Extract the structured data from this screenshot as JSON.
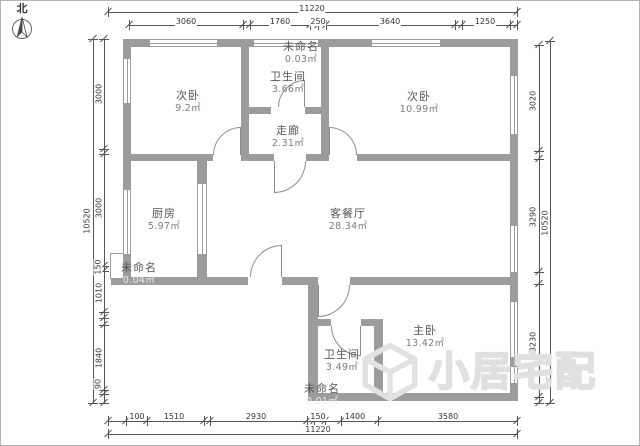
{
  "north": {
    "label": "北"
  },
  "watermark": {
    "brand": "小居宅配"
  },
  "rooms": [
    {
      "id": "bedroom-left",
      "name": "次卧",
      "area": "9.2㎡"
    },
    {
      "id": "bathroom-top",
      "name": "卫生间",
      "area": "3.66㎡"
    },
    {
      "id": "unnamed-top",
      "name": "未命名",
      "area": "0.03㎡"
    },
    {
      "id": "bedroom-right",
      "name": "次卧",
      "area": "10.99㎡"
    },
    {
      "id": "corridor",
      "name": "走廊",
      "area": "2.31㎡"
    },
    {
      "id": "kitchen",
      "name": "厨房",
      "area": "5.97㎡"
    },
    {
      "id": "living-dining",
      "name": "客餐厅",
      "area": "28.34㎡"
    },
    {
      "id": "unnamed-left",
      "name": "未命名",
      "area": "0.04㎡"
    },
    {
      "id": "master-bedroom",
      "name": "主卧",
      "area": "13.42㎡"
    },
    {
      "id": "bathroom-bottom",
      "name": "卫生间",
      "area": "3.49㎡"
    },
    {
      "id": "unnamed-bottom",
      "name": "未命名",
      "area": "0.01㎡"
    }
  ],
  "dimensions": {
    "top": {
      "total": "11220",
      "segments": [
        "3060",
        "1760",
        "250",
        "3640",
        "1250"
      ]
    },
    "bottom": {
      "total": "11220",
      "segments": [
        "100",
        "1510",
        "2930",
        "150",
        "1400",
        "3580"
      ]
    },
    "left": {
      "total": "10520",
      "segments": [
        "3000",
        "3000",
        "150",
        "1010",
        "1840",
        "90"
      ]
    },
    "right": {
      "total": "10520",
      "segments": [
        "3020",
        "3290",
        "3230"
      ]
    }
  },
  "colors": {
    "wall": "#9c9c9c",
    "dimension_line": "#555555",
    "room_text": "#555555",
    "watermark": "#e0e0e0"
  }
}
